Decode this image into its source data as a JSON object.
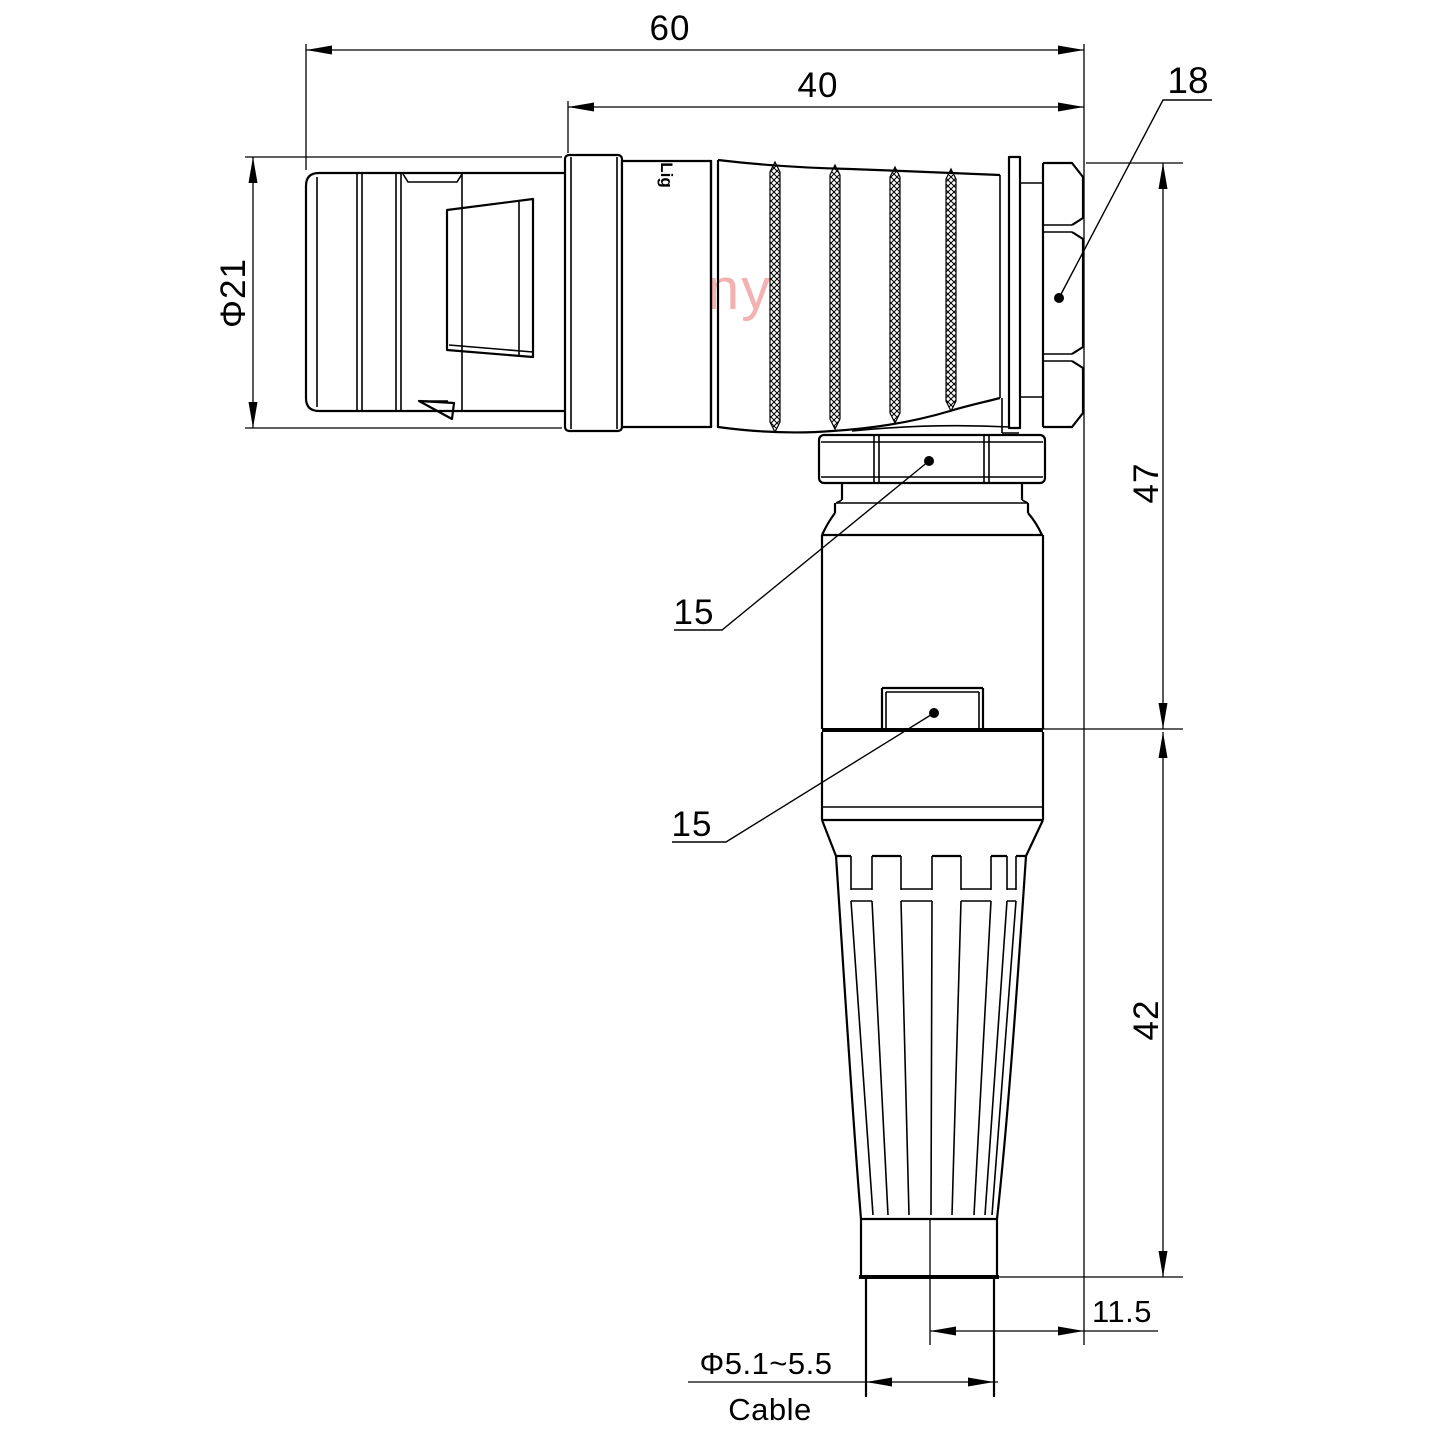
{
  "colors": {
    "line": "#000000",
    "watermark": "#f3b1b1",
    "background": "#ffffff"
  },
  "watermark": {
    "text": "Lightany"
  },
  "body_logo": {
    "text": "Lig"
  },
  "dims": {
    "overall_length": "60",
    "rear_length": "40",
    "hex_nut_size": "18",
    "shell_diameter": "Φ21",
    "upper_height": "47",
    "lower_height": "42",
    "coupling_nut_size": "15",
    "housing_size": "15",
    "axis_offset": "11.5",
    "cable_diameter": "Φ5.1~5.5",
    "cable_label": "Cable"
  }
}
